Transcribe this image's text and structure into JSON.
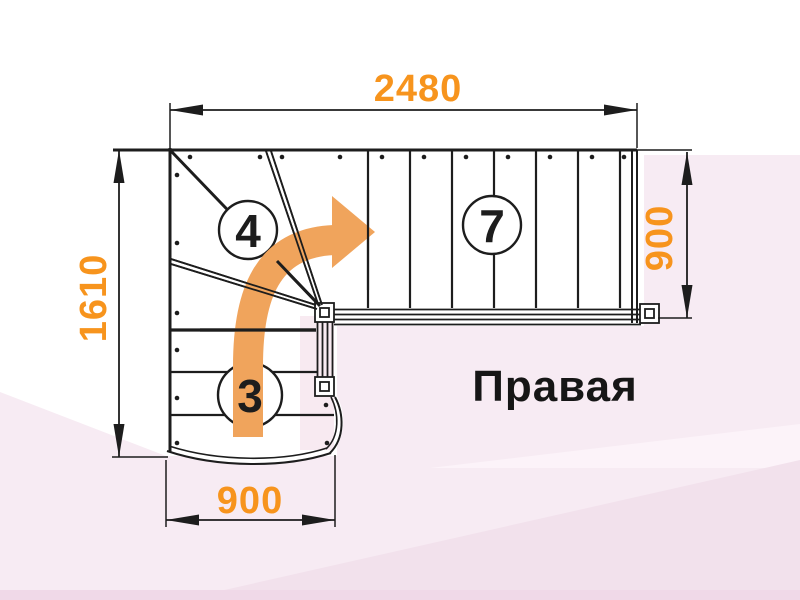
{
  "diagram": {
    "orientation_label": "Правая",
    "dim_top": "2480",
    "dim_left": "1610",
    "dim_right": "900",
    "dim_bottom": "900",
    "count_winder": "4",
    "count_upper_flight": "7",
    "count_lower_flight": "3",
    "colors": {
      "dimension_text": "#f7941d",
      "arrow": "#f0a45c",
      "line": "#1d1d1d",
      "label_text": "#161616",
      "background": "#ffffff",
      "background_pink": "#f7ebf3",
      "background_pink_light": "#fcf3f9",
      "background_pink_deep": "#f2e1ec",
      "stair_fill": "#ffffff"
    }
  }
}
